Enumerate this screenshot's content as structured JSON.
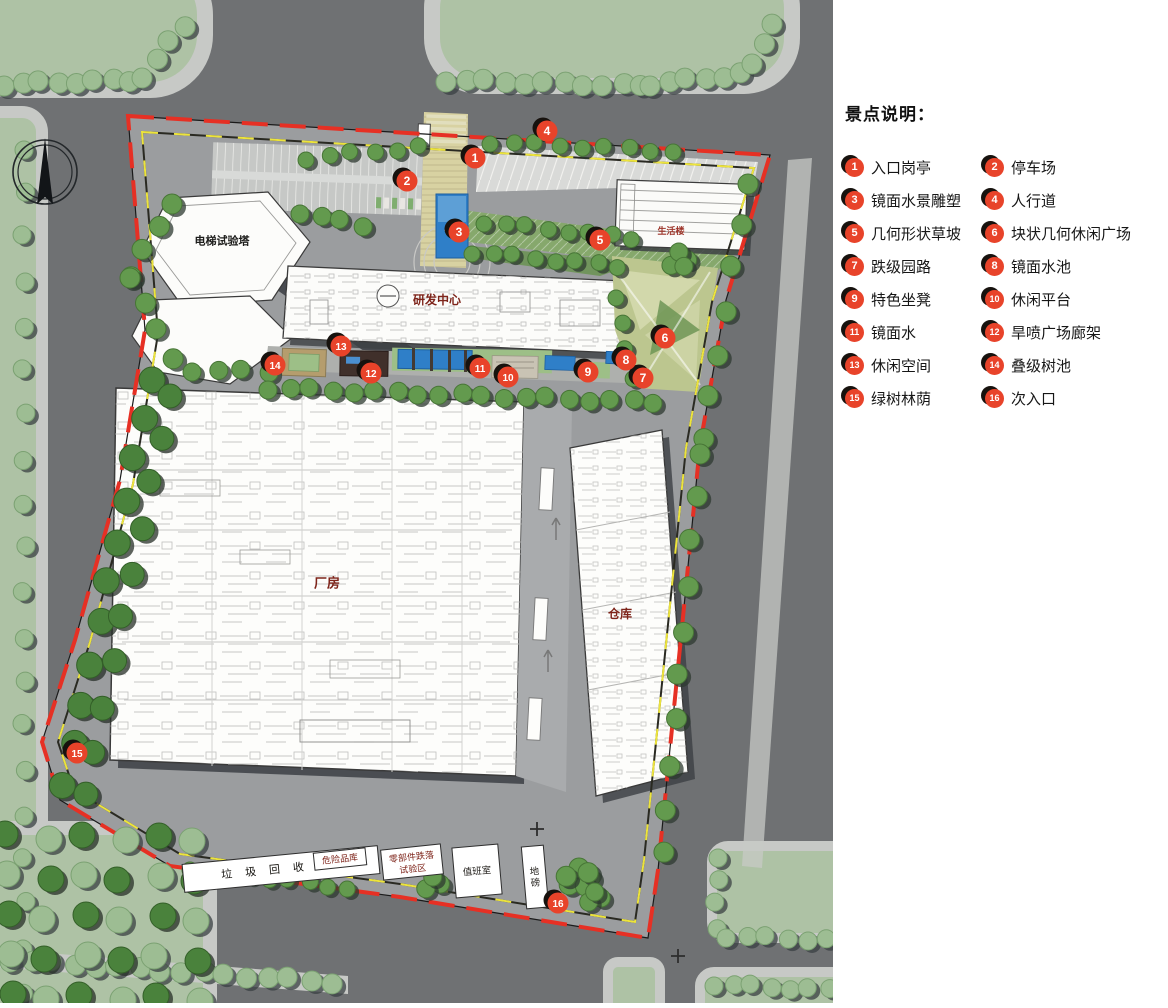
{
  "legend": {
    "title": "景点说明：",
    "items": [
      {
        "num": "1",
        "label": "入口岗亭"
      },
      {
        "num": "2",
        "label": "停车场"
      },
      {
        "num": "3",
        "label": "镜面水景雕塑"
      },
      {
        "num": "4",
        "label": "人行道"
      },
      {
        "num": "5",
        "label": "几何形状草坡"
      },
      {
        "num": "6",
        "label": "块状几何休闲广场"
      },
      {
        "num": "7",
        "label": "跌级园路"
      },
      {
        "num": "8",
        "label": "镜面水池"
      },
      {
        "num": "9",
        "label": "特色坐凳"
      },
      {
        "num": "10",
        "label": "休闲平台"
      },
      {
        "num": "11",
        "label": "镜面水"
      },
      {
        "num": "12",
        "label": "旱喷广场廊架"
      },
      {
        "num": "13",
        "label": "休闲空间"
      },
      {
        "num": "14",
        "label": "叠级树池"
      },
      {
        "num": "15",
        "label": "绿树林荫"
      },
      {
        "num": "16",
        "label": "次入口"
      }
    ]
  },
  "map": {
    "markers": [
      {
        "num": "1",
        "x": 475,
        "y": 158
      },
      {
        "num": "2",
        "x": 407,
        "y": 181
      },
      {
        "num": "3",
        "x": 459,
        "y": 232
      },
      {
        "num": "4",
        "x": 547,
        "y": 131
      },
      {
        "num": "5",
        "x": 600,
        "y": 240
      },
      {
        "num": "6",
        "x": 665,
        "y": 338
      },
      {
        "num": "7",
        "x": 643,
        "y": 378
      },
      {
        "num": "8",
        "x": 626,
        "y": 360
      },
      {
        "num": "9",
        "x": 588,
        "y": 372
      },
      {
        "num": "10",
        "x": 508,
        "y": 377
      },
      {
        "num": "11",
        "x": 480,
        "y": 368
      },
      {
        "num": "12",
        "x": 371,
        "y": 373
      },
      {
        "num": "13",
        "x": 341,
        "y": 346
      },
      {
        "num": "14",
        "x": 275,
        "y": 365
      },
      {
        "num": "15",
        "x": 77,
        "y": 753
      },
      {
        "num": "16",
        "x": 558,
        "y": 903
      }
    ],
    "labels": [
      {
        "id": "elevator-test-tower",
        "text": "电梯试验塔",
        "x": 222,
        "y": 241,
        "color": "#1d1d1b",
        "size": 11,
        "bold": true
      },
      {
        "id": "rd-center",
        "text": "研发中心",
        "x": 437,
        "y": 300,
        "color": "#7e241a",
        "size": 12,
        "bold": true
      },
      {
        "id": "living-building",
        "text": "生活楼",
        "x": 671,
        "y": 231,
        "color": "#9c3328",
        "size": 9,
        "bold": true
      },
      {
        "id": "factory",
        "text": "厂房",
        "x": 327,
        "y": 583,
        "color": "#7e241a",
        "size": 13,
        "bold": true
      },
      {
        "id": "warehouse",
        "text": "仓库",
        "x": 620,
        "y": 614,
        "color": "#7e241a",
        "size": 12,
        "bold": true
      },
      {
        "id": "garbage-recycling-station",
        "text": "垃圾回收站",
        "x": 281,
        "y": 869,
        "color": "#15130f",
        "size": 11,
        "spacing": 13,
        "rotate": -5.5,
        "box": {
          "w": 196,
          "h": 28
        }
      },
      {
        "id": "hazardous-goods-warehouse",
        "text": "危险品库",
        "x": 340,
        "y": 859,
        "color": "#7e241a",
        "size": 9,
        "rotate": -6,
        "box": {
          "w": 52,
          "h": 17
        }
      },
      {
        "id": "parts-drop-test-area",
        "text": "零部件跌落",
        "text2": "试验区",
        "x": 412,
        "y": 862,
        "color": "#7e241a",
        "size": 9,
        "rotate": -6,
        "box": {
          "w": 60,
          "h": 30
        }
      },
      {
        "id": "duty-room",
        "text": "值班室",
        "x": 477,
        "y": 871,
        "color": "#23201c",
        "size": 9.5,
        "rotate": -5,
        "box": {
          "w": 46,
          "h": 50
        }
      },
      {
        "id": "weighbridge",
        "text": "地磅",
        "x": 535,
        "y": 877,
        "color": "#23201c",
        "size": 9.5,
        "vertical": true,
        "rotate": -5,
        "box": {
          "w": 22,
          "h": 62
        }
      }
    ],
    "cross_marks": [
      {
        "x": 537,
        "y": 829
      },
      {
        "x": 678,
        "y": 956
      }
    ],
    "north_arrow": {
      "x": 45,
      "y": 172
    },
    "colors": {
      "marker_red": "#e8432a",
      "boundary_red": "#e63024",
      "boundary_yellow": "#ede43c",
      "water_blue": "#2f7fc8",
      "road_gray": "#6f7173",
      "sidewalk": "#c7c9c6",
      "grass_street": "#aec2a5",
      "tree_street": "#9dbd93",
      "tree_site": "#639a4e",
      "site_ground": "#9b9d9f",
      "building_white": "#fcfcfa",
      "label_red": "#7e241a",
      "deck_brown": "#40302b",
      "plaza_green": "#bcc68f"
    }
  }
}
